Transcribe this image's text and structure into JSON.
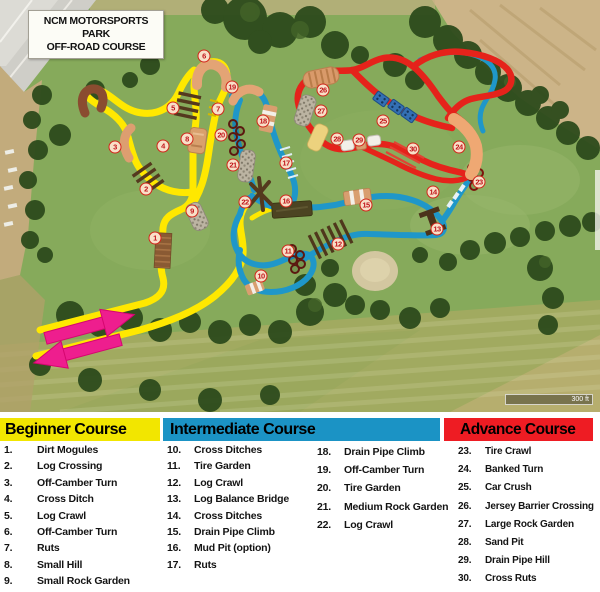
{
  "title_box": {
    "line1": "NCM MOTORSPORTS PARK",
    "line2": "OFF-ROAD COURSE"
  },
  "map": {
    "scale_label": "300 ft",
    "markers": [
      {
        "n": "1",
        "x": 155,
        "y": 238
      },
      {
        "n": "2",
        "x": 146,
        "y": 189
      },
      {
        "n": "3",
        "x": 115,
        "y": 147
      },
      {
        "n": "4",
        "x": 163,
        "y": 146
      },
      {
        "n": "5",
        "x": 173,
        "y": 108
      },
      {
        "n": "6",
        "x": 204,
        "y": 56
      },
      {
        "n": "7",
        "x": 218,
        "y": 109
      },
      {
        "n": "8",
        "x": 187,
        "y": 139
      },
      {
        "n": "9",
        "x": 192,
        "y": 211
      },
      {
        "n": "10",
        "x": 261,
        "y": 276
      },
      {
        "n": "11",
        "x": 288,
        "y": 251
      },
      {
        "n": "12",
        "x": 338,
        "y": 244
      },
      {
        "n": "13",
        "x": 437,
        "y": 229
      },
      {
        "n": "14",
        "x": 433,
        "y": 192
      },
      {
        "n": "15",
        "x": 366,
        "y": 205
      },
      {
        "n": "16",
        "x": 286,
        "y": 201
      },
      {
        "n": "17",
        "x": 286,
        "y": 163
      },
      {
        "n": "18",
        "x": 263,
        "y": 121
      },
      {
        "n": "19",
        "x": 232,
        "y": 87
      },
      {
        "n": "20",
        "x": 221,
        "y": 135
      },
      {
        "n": "21",
        "x": 233,
        "y": 165
      },
      {
        "n": "22",
        "x": 245,
        "y": 202
      },
      {
        "n": "23",
        "x": 479,
        "y": 182
      },
      {
        "n": "24",
        "x": 459,
        "y": 147
      },
      {
        "n": "25",
        "x": 383,
        "y": 121
      },
      {
        "n": "26",
        "x": 323,
        "y": 90
      },
      {
        "n": "27",
        "x": 321,
        "y": 111
      },
      {
        "n": "28",
        "x": 337,
        "y": 139
      },
      {
        "n": "29",
        "x": 359,
        "y": 140
      },
      {
        "n": "30",
        "x": 413,
        "y": 149
      }
    ]
  },
  "legend": {
    "beginner": {
      "title": "Beginner Course",
      "color": "#f2e600",
      "items": [
        {
          "num": "1.",
          "label": "Dirt Mogules"
        },
        {
          "num": "2.",
          "label": "Log Crossing"
        },
        {
          "num": "3.",
          "label": "Off-Camber Turn"
        },
        {
          "num": "4.",
          "label": "Cross Ditch"
        },
        {
          "num": "5.",
          "label": "Log Crawl"
        },
        {
          "num": "6.",
          "label": "Off-Camber Turn"
        },
        {
          "num": "7.",
          "label": "Ruts"
        },
        {
          "num": "8.",
          "label": "Small Hill"
        },
        {
          "num": "9.",
          "label": "Small Rock Garden"
        }
      ]
    },
    "intermediate": {
      "title": "Intermediate Course",
      "color": "#1b93c5",
      "items_left": [
        {
          "num": "10.",
          "label": "Cross Ditches"
        },
        {
          "num": "11.",
          "label": "Tire Garden"
        },
        {
          "num": "12.",
          "label": "Log Crawl"
        },
        {
          "num": "13.",
          "label": "Log Balance Bridge"
        },
        {
          "num": "14.",
          "label": "Cross Ditches"
        },
        {
          "num": "15.",
          "label": "Drain Pipe Climb"
        },
        {
          "num": "16.",
          "label": "Mud Pit (option)"
        },
        {
          "num": "17.",
          "label": "Ruts"
        }
      ],
      "items_right": [
        {
          "num": "18.",
          "label": "Drain Pipe Climb"
        },
        {
          "num": "19.",
          "label": "Off-Camber Turn"
        },
        {
          "num": "20.",
          "label": "Tire Garden"
        },
        {
          "num": "21.",
          "label": "Medium Rock Garden"
        },
        {
          "num": "22.",
          "label": "Log Crawl"
        }
      ]
    },
    "advance": {
      "title": "Advance Course",
      "color": "#ee1c23",
      "items": [
        {
          "num": "23.",
          "label": "Tire Crawl"
        },
        {
          "num": "24.",
          "label": "Banked Turn"
        },
        {
          "num": "25.",
          "label": "Car Crush"
        },
        {
          "num": "26.",
          "label": "Jersey Barrier Crossing"
        },
        {
          "num": "27.",
          "label": "Large Rock Garden"
        },
        {
          "num": "28.",
          "label": "Sand Pit"
        },
        {
          "num": "29.",
          "label": "Drain Pipe Hill"
        },
        {
          "num": "30.",
          "label": "Cross Ruts"
        }
      ]
    }
  },
  "colors": {
    "beginner_path": "#ffe800",
    "intermediate_path": "#1f97c9",
    "advance_path": "#e5231b",
    "entrance_arrows": "#ee1e8e"
  }
}
